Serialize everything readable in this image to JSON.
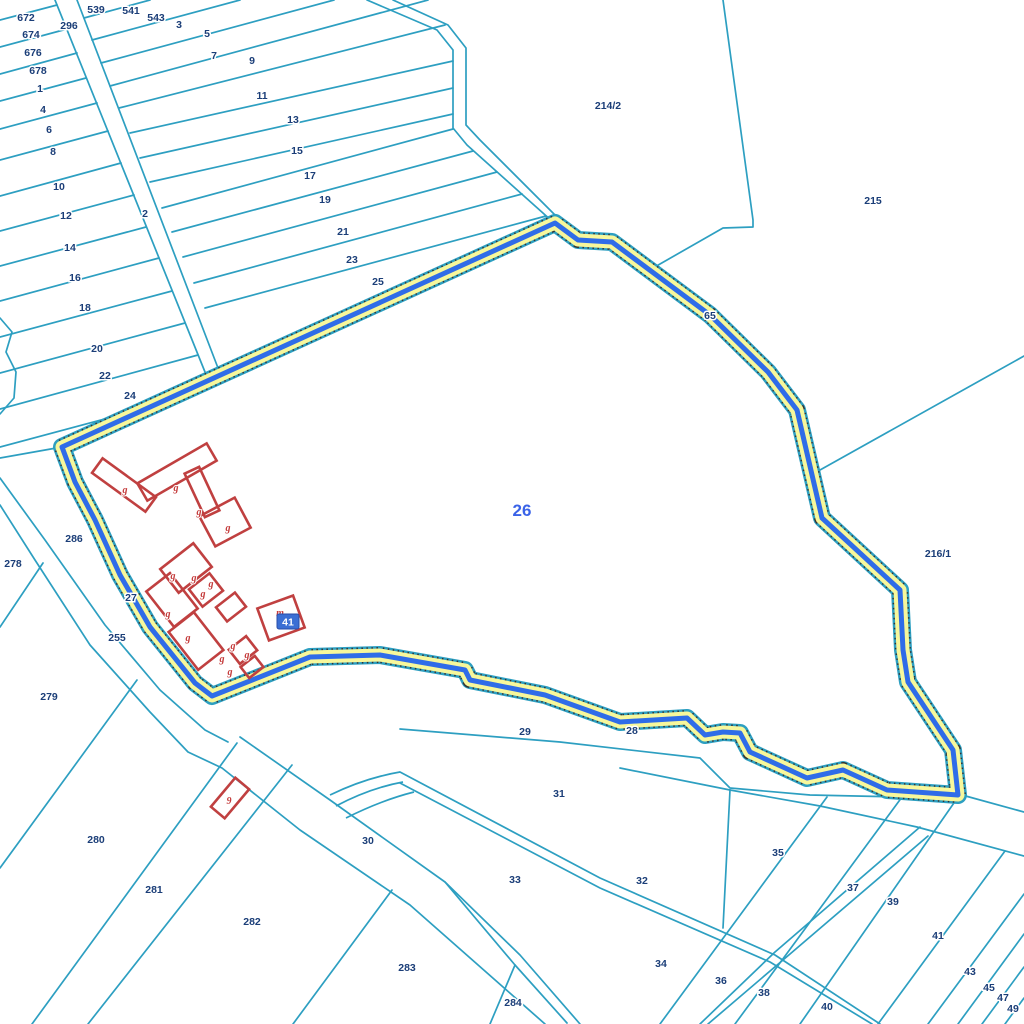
{
  "map": {
    "title": "cadastral-parcel-map",
    "colors": {
      "parcel_line": "#2d9fc1",
      "label": "#1b3e78",
      "selected_label": "#3a63e8",
      "building": "#c04040",
      "highlight_yellow": "#f7f79b",
      "highlight_blue": "#2f6ce8",
      "highlight_dots": "#333333",
      "badge_bg": "#3b6fd4",
      "badge_text": "#ffffff",
      "background": "#ffffff"
    },
    "selected_parcel": {
      "number": "26",
      "label_x": 522,
      "label_y": 516
    },
    "badge": {
      "text": "41",
      "x": 277,
      "y": 614,
      "w": 22,
      "h": 15
    },
    "parcel_boundary": [
      [
        62,
        447
      ],
      [
        555,
        223
      ],
      [
        578,
        240
      ],
      [
        612,
        242
      ],
      [
        710,
        315
      ],
      [
        768,
        372
      ],
      [
        797,
        410
      ],
      [
        822,
        518
      ],
      [
        900,
        590
      ],
      [
        903,
        650
      ],
      [
        908,
        682
      ],
      [
        953,
        750
      ],
      [
        958,
        795
      ],
      [
        887,
        790
      ],
      [
        843,
        770
      ],
      [
        807,
        778
      ],
      [
        750,
        752
      ],
      [
        740,
        733
      ],
      [
        723,
        732
      ],
      [
        705,
        735
      ],
      [
        687,
        718
      ],
      [
        620,
        722
      ],
      [
        545,
        695
      ],
      [
        470,
        680
      ],
      [
        465,
        670
      ],
      [
        380,
        655
      ],
      [
        310,
        657
      ],
      [
        212,
        696
      ],
      [
        195,
        683
      ],
      [
        150,
        627
      ],
      [
        120,
        575
      ],
      [
        95,
        520
      ],
      [
        75,
        482
      ]
    ],
    "labels": [
      {
        "t": "539",
        "x": 96,
        "y": 9
      },
      {
        "t": "541",
        "x": 131,
        "y": 10
      },
      {
        "t": "543",
        "x": 156,
        "y": 17
      },
      {
        "t": "3",
        "x": 179,
        "y": 24
      },
      {
        "t": "5",
        "x": 207,
        "y": 33
      },
      {
        "t": "7",
        "x": 214,
        "y": 55
      },
      {
        "t": "9",
        "x": 252,
        "y": 60
      },
      {
        "t": "11",
        "x": 262,
        "y": 95
      },
      {
        "t": "13",
        "x": 293,
        "y": 119
      },
      {
        "t": "15",
        "x": 297,
        "y": 150
      },
      {
        "t": "17",
        "x": 310,
        "y": 175
      },
      {
        "t": "19",
        "x": 325,
        "y": 199
      },
      {
        "t": "21",
        "x": 343,
        "y": 231
      },
      {
        "t": "23",
        "x": 352,
        "y": 259
      },
      {
        "t": "25",
        "x": 378,
        "y": 281
      },
      {
        "t": "672",
        "x": 26,
        "y": 17
      },
      {
        "t": "296",
        "x": 69,
        "y": 25
      },
      {
        "t": "674",
        "x": 31,
        "y": 34
      },
      {
        "t": "676",
        "x": 33,
        "y": 52
      },
      {
        "t": "678",
        "x": 38,
        "y": 70
      },
      {
        "t": "1",
        "x": 40,
        "y": 88
      },
      {
        "t": "4",
        "x": 43,
        "y": 109
      },
      {
        "t": "6",
        "x": 49,
        "y": 129
      },
      {
        "t": "8",
        "x": 53,
        "y": 151
      },
      {
        "t": "10",
        "x": 59,
        "y": 186
      },
      {
        "t": "12",
        "x": 66,
        "y": 215
      },
      {
        "t": "14",
        "x": 70,
        "y": 247
      },
      {
        "t": "16",
        "x": 75,
        "y": 277
      },
      {
        "t": "18",
        "x": 85,
        "y": 307
      },
      {
        "t": "20",
        "x": 97,
        "y": 348
      },
      {
        "t": "22",
        "x": 105,
        "y": 375
      },
      {
        "t": "24",
        "x": 130,
        "y": 395
      },
      {
        "t": "2",
        "x": 145,
        "y": 213
      },
      {
        "t": "214/2",
        "x": 608,
        "y": 105
      },
      {
        "t": "215",
        "x": 873,
        "y": 200
      },
      {
        "t": "65",
        "x": 710,
        "y": 315
      },
      {
        "t": "216/1",
        "x": 938,
        "y": 553
      },
      {
        "t": "286",
        "x": 74,
        "y": 538
      },
      {
        "t": "278",
        "x": 13,
        "y": 563
      },
      {
        "t": "27",
        "x": 131,
        "y": 597
      },
      {
        "t": "255",
        "x": 117,
        "y": 637
      },
      {
        "t": "279",
        "x": 49,
        "y": 696
      },
      {
        "t": "280",
        "x": 96,
        "y": 839
      },
      {
        "t": "281",
        "x": 154,
        "y": 889
      },
      {
        "t": "282",
        "x": 252,
        "y": 921
      },
      {
        "t": "283",
        "x": 407,
        "y": 967
      },
      {
        "t": "284",
        "x": 513,
        "y": 1002
      },
      {
        "t": "30",
        "x": 368,
        "y": 840
      },
      {
        "t": "29",
        "x": 525,
        "y": 731
      },
      {
        "t": "28",
        "x": 632,
        "y": 730
      },
      {
        "t": "31",
        "x": 559,
        "y": 793
      },
      {
        "t": "33",
        "x": 515,
        "y": 879
      },
      {
        "t": "32",
        "x": 642,
        "y": 880
      },
      {
        "t": "34",
        "x": 661,
        "y": 963
      },
      {
        "t": "36",
        "x": 721,
        "y": 980
      },
      {
        "t": "38",
        "x": 764,
        "y": 992
      },
      {
        "t": "40",
        "x": 827,
        "y": 1006
      },
      {
        "t": "35",
        "x": 778,
        "y": 852
      },
      {
        "t": "37",
        "x": 853,
        "y": 887
      },
      {
        "t": "39",
        "x": 893,
        "y": 901
      },
      {
        "t": "41",
        "x": 938,
        "y": 935
      },
      {
        "t": "43",
        "x": 970,
        "y": 971
      },
      {
        "t": "45",
        "x": 989,
        "y": 987
      },
      {
        "t": "47",
        "x": 1003,
        "y": 997
      },
      {
        "t": "49",
        "x": 1013,
        "y": 1008
      }
    ],
    "building_labels": [
      {
        "t": "g",
        "x": 125,
        "y": 489
      },
      {
        "t": "g",
        "x": 176,
        "y": 487
      },
      {
        "t": "g",
        "x": 199,
        "y": 511
      },
      {
        "t": "g",
        "x": 228,
        "y": 527
      },
      {
        "t": "g",
        "x": 173,
        "y": 575
      },
      {
        "t": "g",
        "x": 194,
        "y": 577
      },
      {
        "t": "g",
        "x": 211,
        "y": 583
      },
      {
        "t": "g",
        "x": 203,
        "y": 593
      },
      {
        "t": "g",
        "x": 168,
        "y": 613
      },
      {
        "t": "g",
        "x": 188,
        "y": 637
      },
      {
        "t": "g",
        "x": 233,
        "y": 645
      },
      {
        "t": "g",
        "x": 222,
        "y": 658
      },
      {
        "t": "g",
        "x": 247,
        "y": 654
      },
      {
        "t": "g",
        "x": 230,
        "y": 671
      },
      {
        "t": "m",
        "x": 280,
        "y": 612
      },
      {
        "t": "9",
        "x": 229,
        "y": 800
      }
    ],
    "buildings": [
      {
        "x": 124,
        "y": 485,
        "w": 66,
        "h": 18,
        "r": 36
      },
      {
        "x": 177,
        "y": 472,
        "w": 80,
        "h": 20,
        "r": -30
      },
      {
        "x": 202,
        "y": 492,
        "w": 16,
        "h": 48,
        "r": -25
      },
      {
        "x": 225,
        "y": 522,
        "w": 40,
        "h": 34,
        "r": -28
      },
      {
        "x": 186,
        "y": 568,
        "w": 42,
        "h": 30,
        "r": -38
      },
      {
        "x": 206,
        "y": 590,
        "w": 26,
        "h": 22,
        "r": -38
      },
      {
        "x": 172,
        "y": 600,
        "w": 30,
        "h": 45,
        "r": -38
      },
      {
        "x": 231,
        "y": 607,
        "w": 24,
        "h": 18,
        "r": -38
      },
      {
        "x": 196,
        "y": 641,
        "w": 32,
        "h": 48,
        "r": -38
      },
      {
        "x": 243,
        "y": 650,
        "w": 22,
        "h": 18,
        "r": -38
      },
      {
        "x": 252,
        "y": 667,
        "w": 18,
        "h": 14,
        "r": -38
      },
      {
        "x": 281,
        "y": 618,
        "w": 38,
        "h": 34,
        "r": -20
      },
      {
        "x": 230,
        "y": 798,
        "w": 38,
        "h": 18,
        "r": -50
      }
    ],
    "lines": [
      [
        [
          0,
          20
        ],
        [
          57,
          5
        ]
      ],
      [
        [
          0,
          47
        ],
        [
          67,
          29
        ]
      ],
      [
        [
          0,
          74
        ],
        [
          77,
          53
        ]
      ],
      [
        [
          0,
          101
        ],
        [
          86,
          78
        ]
      ],
      [
        [
          0,
          129
        ],
        [
          97,
          103
        ]
      ],
      [
        [
          0,
          160
        ],
        [
          108,
          131
        ]
      ],
      [
        [
          0,
          196
        ],
        [
          121,
          163
        ]
      ],
      [
        [
          0,
          231
        ],
        [
          134,
          195
        ]
      ],
      [
        [
          0,
          266
        ],
        [
          146,
          227
        ]
      ],
      [
        [
          0,
          301
        ],
        [
          159,
          258
        ]
      ],
      [
        [
          0,
          337
        ],
        [
          172,
          291
        ]
      ],
      [
        [
          0,
          373
        ],
        [
          185,
          323
        ]
      ],
      [
        [
          0,
          409
        ],
        [
          198,
          355
        ]
      ],
      [
        [
          0,
          447
        ],
        [
          153,
          406
        ]
      ],
      [
        [
          84,
          18
        ],
        [
          150,
          0
        ]
      ],
      [
        [
          92,
          40
        ],
        [
          240,
          0
        ]
      ],
      [
        [
          101,
          63
        ],
        [
          334,
          0
        ]
      ],
      [
        [
          110,
          86
        ],
        [
          428,
          0
        ]
      ],
      [
        [
          119,
          108
        ],
        [
          445,
          25
        ]
      ],
      [
        [
          130,
          133
        ],
        [
          453,
          61
        ]
      ],
      [
        [
          140,
          158
        ],
        [
          453,
          88
        ]
      ],
      [
        [
          150,
          182
        ],
        [
          453,
          114
        ]
      ],
      [
        [
          162,
          208
        ],
        [
          453,
          129
        ]
      ],
      [
        [
          172,
          232
        ],
        [
          473,
          151
        ]
      ],
      [
        [
          183,
          257
        ],
        [
          497,
          172
        ]
      ],
      [
        [
          194,
          283
        ],
        [
          522,
          194
        ]
      ],
      [
        [
          205,
          308
        ],
        [
          546,
          216
        ]
      ],
      [
        [
          55,
          0
        ],
        [
          205,
          372
        ]
      ],
      [
        [
          77,
          0
        ],
        [
          218,
          368
        ]
      ],
      [
        [
          367,
          0
        ],
        [
          437,
          30
        ],
        [
          453,
          50
        ],
        [
          453,
          128
        ],
        [
          467,
          145
        ],
        [
          553,
          222
        ]
      ],
      [
        [
          393,
          0
        ],
        [
          448,
          25
        ],
        [
          466,
          48
        ],
        [
          466,
          125
        ],
        [
          480,
          140
        ],
        [
          558,
          218
        ],
        [
          580,
          236
        ],
        [
          614,
          240
        ],
        [
          712,
          312
        ],
        [
          770,
          370
        ],
        [
          800,
          412
        ],
        [
          824,
          520
        ],
        [
          902,
          588
        ],
        [
          906,
          652
        ],
        [
          910,
          682
        ],
        [
          956,
          748
        ],
        [
          962,
          795
        ],
        [
          1024,
          812
        ]
      ],
      [
        [
          723,
          0
        ],
        [
          753,
          220
        ],
        [
          753,
          227
        ],
        [
          723,
          228
        ],
        [
          653,
          268
        ]
      ],
      [
        [
          820,
          470
        ],
        [
          1024,
          356
        ]
      ],
      [
        [
          0,
          318
        ],
        [
          12,
          332
        ],
        [
          6,
          352
        ],
        [
          16,
          372
        ],
        [
          14,
          398
        ],
        [
          0,
          414
        ]
      ],
      [
        [
          0,
          458
        ],
        [
          62,
          447
        ]
      ],
      [
        [
          0,
          478
        ],
        [
          45,
          540
        ],
        [
          105,
          625
        ],
        [
          160,
          690
        ],
        [
          205,
          730
        ],
        [
          228,
          742
        ]
      ],
      [
        [
          0,
          505
        ],
        [
          35,
          560
        ],
        [
          90,
          645
        ],
        [
          150,
          712
        ],
        [
          188,
          752
        ],
        [
          222,
          768
        ],
        [
          300,
          830
        ],
        [
          410,
          905
        ],
        [
          545,
          1024
        ]
      ],
      [
        [
          43,
          563
        ],
        [
          0,
          627
        ]
      ],
      [
        [
          240,
          737
        ],
        [
          330,
          800
        ],
        [
          445,
          882
        ],
        [
          520,
          955
        ],
        [
          580,
          1024
        ]
      ],
      [
        [
          137,
          680
        ],
        [
          0,
          868
        ]
      ],
      [
        [
          237,
          743
        ],
        [
          32,
          1024
        ]
      ],
      [
        [
          292,
          765
        ],
        [
          88,
          1024
        ]
      ],
      [
        [
          392,
          890
        ],
        [
          293,
          1024
        ]
      ],
      [
        [
          445,
          882
        ],
        [
          515,
          965
        ]
      ],
      [
        [
          515,
          965
        ],
        [
          490,
          1024
        ]
      ],
      [
        [
          515,
          965
        ],
        [
          567,
          1023
        ]
      ],
      [
        [
          400,
          729
        ],
        [
          560,
          742
        ],
        [
          700,
          758
        ],
        [
          730,
          788
        ],
        [
          810,
          795
        ],
        [
          950,
          798
        ]
      ],
      [
        [
          620,
          768
        ],
        [
          730,
          790
        ]
      ],
      [
        [
          730,
          790
        ],
        [
          820,
          806
        ],
        [
          917,
          827
        ],
        [
          1024,
          856
        ]
      ],
      [
        [
          730,
          790
        ],
        [
          723,
          928
        ]
      ],
      [
        [
          400,
          772
        ],
        [
          600,
          878
        ],
        [
          775,
          955
        ],
        [
          880,
          1024
        ]
      ],
      [
        [
          400,
          783
        ],
        [
          600,
          888
        ],
        [
          770,
          962
        ],
        [
          872,
          1024
        ]
      ],
      [
        [
          920,
          827
        ],
        [
          775,
          952
        ],
        [
          700,
          1024
        ]
      ],
      [
        [
          928,
          836
        ],
        [
          783,
          960
        ],
        [
          708,
          1024
        ]
      ],
      [
        [
          660,
          1024
        ],
        [
          827,
          797
        ]
      ],
      [
        [
          735,
          1024
        ],
        [
          902,
          797
        ]
      ],
      [
        [
          800,
          1024
        ],
        [
          956,
          800
        ]
      ],
      [
        [
          878,
          1024
        ],
        [
          1005,
          851
        ]
      ],
      [
        [
          928,
          1024
        ],
        [
          1024,
          894
        ]
      ],
      [
        [
          958,
          1024
        ],
        [
          1024,
          934
        ]
      ],
      [
        [
          982,
          1024
        ],
        [
          1024,
          967
        ]
      ],
      [
        [
          1005,
          1024
        ],
        [
          1024,
          998
        ]
      ]
    ],
    "curves": [
      "M330,795 Q365,778 400,772",
      "M336,806 Q370,788 403,782",
      "M346,818 Q382,800 414,792"
    ]
  }
}
